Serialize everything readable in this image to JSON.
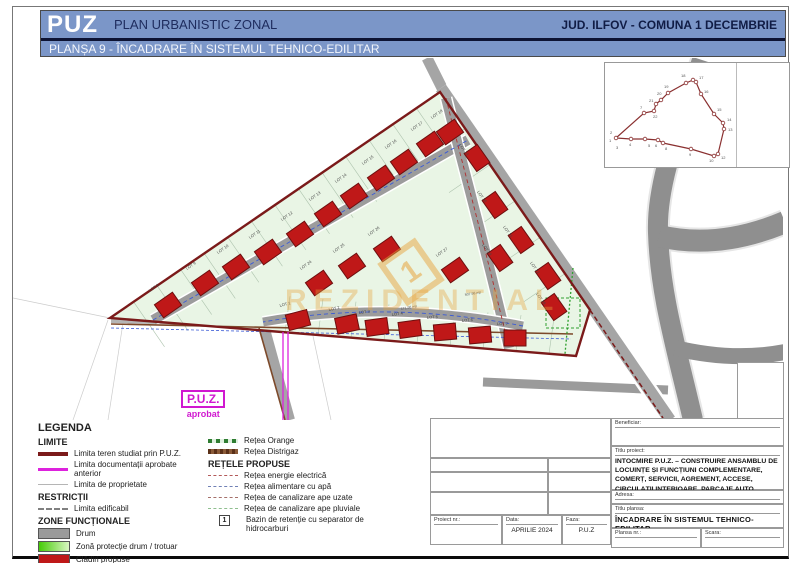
{
  "header": {
    "logo": "PUZ",
    "subtitle": "PLAN URBANISTIC ZONAL",
    "region": "JUD. ILFOV - COMUNA 1 DECEMBRIE",
    "plansa": "PLANȘA 9 - ÎNCADRARE ÎN SISTEMUL TEHNICO-EDILITAR"
  },
  "colors": {
    "header_blue": "#7b96c8",
    "navy_text": "#16214d",
    "site_green": "#e9f5e5",
    "building_red": "#bf1818",
    "boundary_dark_red": "#7b1a1a",
    "magenta": "#dd22dd",
    "road_gray": "#8f8f8f",
    "watermark_orange": "#e8a33d",
    "network_green": "#2fa02f",
    "distrigaz_brown": "#7d4a2b"
  },
  "map": {
    "watermark": "REZIDENTIAL",
    "logo_glyph": "1",
    "puz_aprobat": {
      "line1": "P.U.Z.",
      "line2": "aprobat"
    },
    "bazin_marker": "1",
    "buildings": [
      {
        "x": 155,
        "y": 247,
        "r": -35,
        "label": "LOT 8"
      },
      {
        "x": 192,
        "y": 225,
        "r": -35,
        "label": "LOT 9"
      },
      {
        "x": 223,
        "y": 209,
        "r": -35,
        "label": "LOT 10"
      },
      {
        "x": 255,
        "y": 194,
        "r": -35,
        "label": "LOT 11"
      },
      {
        "x": 287,
        "y": 176,
        "r": -35,
        "label": "LOT 12"
      },
      {
        "x": 315,
        "y": 156,
        "r": -35,
        "label": "LOT 13"
      },
      {
        "x": 341,
        "y": 138,
        "r": -35,
        "label": "LOT 14"
      },
      {
        "x": 368,
        "y": 120,
        "r": -35,
        "label": "LOT 15"
      },
      {
        "x": 391,
        "y": 104,
        "r": -35,
        "label": "LOT 16"
      },
      {
        "x": 417,
        "y": 86,
        "r": -35,
        "label": "LOT 17"
      },
      {
        "x": 437,
        "y": 74,
        "r": -35,
        "label": "LOT 18"
      },
      {
        "x": 464,
        "y": 100,
        "r": 55,
        "label": "LOT 19"
      },
      {
        "x": 482,
        "y": 147,
        "r": 55,
        "label": "LOT 20"
      },
      {
        "x": 508,
        "y": 182,
        "r": 55,
        "label": "LOT 21"
      },
      {
        "x": 535,
        "y": 218,
        "r": 55,
        "label": "LOT 22"
      },
      {
        "x": 541,
        "y": 249,
        "r": 55,
        "label": "LOT 28"
      },
      {
        "x": 306,
        "y": 225,
        "r": -35,
        "label": "LOT 24"
      },
      {
        "x": 339,
        "y": 208,
        "r": -35,
        "label": "LOT 25"
      },
      {
        "x": 374,
        "y": 191,
        "r": -35,
        "label": "LOT 26"
      },
      {
        "x": 442,
        "y": 212,
        "r": -35,
        "label": "LOT 27"
      },
      {
        "x": 487,
        "y": 200,
        "r": 55,
        "label": "LOT 23"
      },
      {
        "x": 285,
        "y": 262,
        "r": -15,
        "label": "LOT 1"
      },
      {
        "x": 334,
        "y": 266,
        "r": -12,
        "label": "LOT 2"
      },
      {
        "x": 364,
        "y": 269,
        "r": -8,
        "label": "LOT 3"
      },
      {
        "x": 397,
        "y": 271,
        "r": -8,
        "label": "LOT 4"
      },
      {
        "x": 432,
        "y": 274,
        "r": -5,
        "label": "LOT 5"
      },
      {
        "x": 467,
        "y": 277,
        "r": -5,
        "label": "LOT 6"
      },
      {
        "x": 502,
        "y": 280,
        "r": 0,
        "label": "LOT 7"
      }
    ],
    "area_labels": [
      {
        "t": "171.98 mp",
        "x": 388,
        "y": 252
      },
      {
        "t": "507.98 mp",
        "x": 452,
        "y": 238
      }
    ]
  },
  "inset": {
    "polygon": [
      [
        11,
        75
      ],
      [
        39,
        50
      ],
      [
        49,
        48
      ],
      [
        51,
        41
      ],
      [
        56,
        37
      ],
      [
        63,
        30
      ],
      [
        81,
        20
      ],
      [
        88,
        17
      ],
      [
        91,
        19
      ],
      [
        96,
        31
      ],
      [
        109,
        51
      ],
      [
        118,
        60
      ],
      [
        119,
        66
      ],
      [
        113,
        91
      ],
      [
        109,
        93
      ],
      [
        86,
        86
      ],
      [
        58,
        80
      ],
      [
        53,
        77
      ],
      [
        40,
        76
      ],
      [
        26,
        76
      ]
    ],
    "labels": [
      {
        "t": "1",
        "x": 4,
        "y": 79
      },
      {
        "t": "2",
        "x": 5,
        "y": 71
      },
      {
        "t": "3",
        "x": 11,
        "y": 86
      },
      {
        "t": "4",
        "x": 24,
        "y": 83
      },
      {
        "t": "5",
        "x": 43,
        "y": 84
      },
      {
        "t": "6",
        "x": 50,
        "y": 84
      },
      {
        "t": "7",
        "x": 35,
        "y": 46
      },
      {
        "t": "8",
        "x": 60,
        "y": 87
      },
      {
        "t": "9",
        "x": 84,
        "y": 93
      },
      {
        "t": "10",
        "x": 104,
        "y": 99
      },
      {
        "t": "12",
        "x": 116,
        "y": 96
      },
      {
        "t": "13",
        "x": 123,
        "y": 68
      },
      {
        "t": "14",
        "x": 122,
        "y": 58
      },
      {
        "t": "15",
        "x": 112,
        "y": 48
      },
      {
        "t": "16",
        "x": 99,
        "y": 30
      },
      {
        "t": "17",
        "x": 94,
        "y": 16
      },
      {
        "t": "18",
        "x": 76,
        "y": 14
      },
      {
        "t": "19",
        "x": 59,
        "y": 25
      },
      {
        "t": "20",
        "x": 52,
        "y": 32
      },
      {
        "t": "21",
        "x": 44,
        "y": 39
      },
      {
        "t": "22",
        "x": 48,
        "y": 55
      }
    ]
  },
  "legend": {
    "title": "LEGENDA",
    "limite": {
      "title": "LIMITE",
      "items": [
        {
          "label": "Limita teren studiat prin P.U.Z."
        },
        {
          "label": "Limita documentații aprobate anterior"
        },
        {
          "label": "Limita de proprietate"
        }
      ]
    },
    "restrictii": {
      "title": "RESTRICȚII",
      "items": [
        {
          "label": "Limita edificabil"
        }
      ]
    },
    "zone": {
      "title": "ZONE FUNCȚIONALE",
      "items": [
        {
          "label": "Drum"
        },
        {
          "label": "Zonă protecție drum / trotuar"
        },
        {
          "label": "Clădiri propuse"
        },
        {
          "label": "Spații verzi"
        },
        {
          "label": "Accese carosabile"
        }
      ]
    },
    "retele_existente": {
      "items": [
        {
          "label": "Rețea Orange"
        },
        {
          "label": "Rețea Distrigaz"
        }
      ]
    },
    "retele_propuse": {
      "title": "REȚELE PROPUSE",
      "items": [
        {
          "label": "Rețea energie electrică"
        },
        {
          "label": "Rețea alimentare cu apă"
        },
        {
          "label": "Rețea de canalizare ape uzate"
        },
        {
          "label": "Rețea de canalizare ape pluviale"
        },
        {
          "label": "Bazin de retenție cu separator de hidrocarburi",
          "badge": "1"
        }
      ]
    }
  },
  "titleblock": {
    "beneficiar_label": "Beneficiar:",
    "titlu_proiect_label": "Titlu proiect:",
    "titlu_proiect": "INTOCMIRE P.U.Z. – CONSTRUIRE ANSAMBLU DE LOCUINȚE ȘI FUNCȚIUNI COMPLEMENTARE, COMERȚ, SERVICII, AGREMENT, ACCESE, CIRCULAȚII INTERIOARE, PARCAJE AUTO, AMENAJĂRI EXTERIOARE, ÎMPREJMUIRE TEREN, UTILITĂȚI",
    "adresa_label": "Adresa:",
    "titlu_plansa_label": "Titlu plansa:",
    "titlu_plansa": "ÎNCADRARE ÎN SISTEMUL TEHNICO-EDILITAR",
    "plansa_nr_label": "Plansa nr.:",
    "scara_label": "Scara:",
    "proiect_nr_label": "Proiect nr.:",
    "data_label": "Data:",
    "data_value": "APRILIE 2024",
    "faza_label": "Faza:",
    "faza_value": "P.U.Z"
  }
}
